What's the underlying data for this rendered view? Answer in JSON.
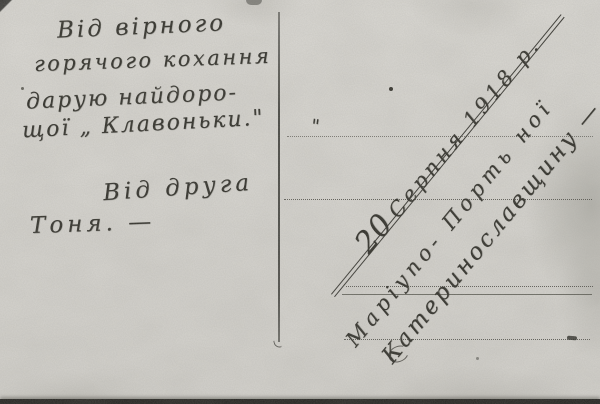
{
  "postcard": {
    "message_lines": [
      "Від вірного",
      "горячого кохання",
      "дарую найдоро-",
      "щої „ Клавоньки.\"",
      "Від друга",
      "Тоня. —"
    ],
    "stray_quote": "\"",
    "date_day": "20",
    "date_rest": "Серпня 1918 р.",
    "address_lines": [
      "Маріупо- Порть ної",
      "Катеринославщину —"
    ],
    "ink_color": "#2b2a24",
    "paper_color": "#dcdad5"
  }
}
